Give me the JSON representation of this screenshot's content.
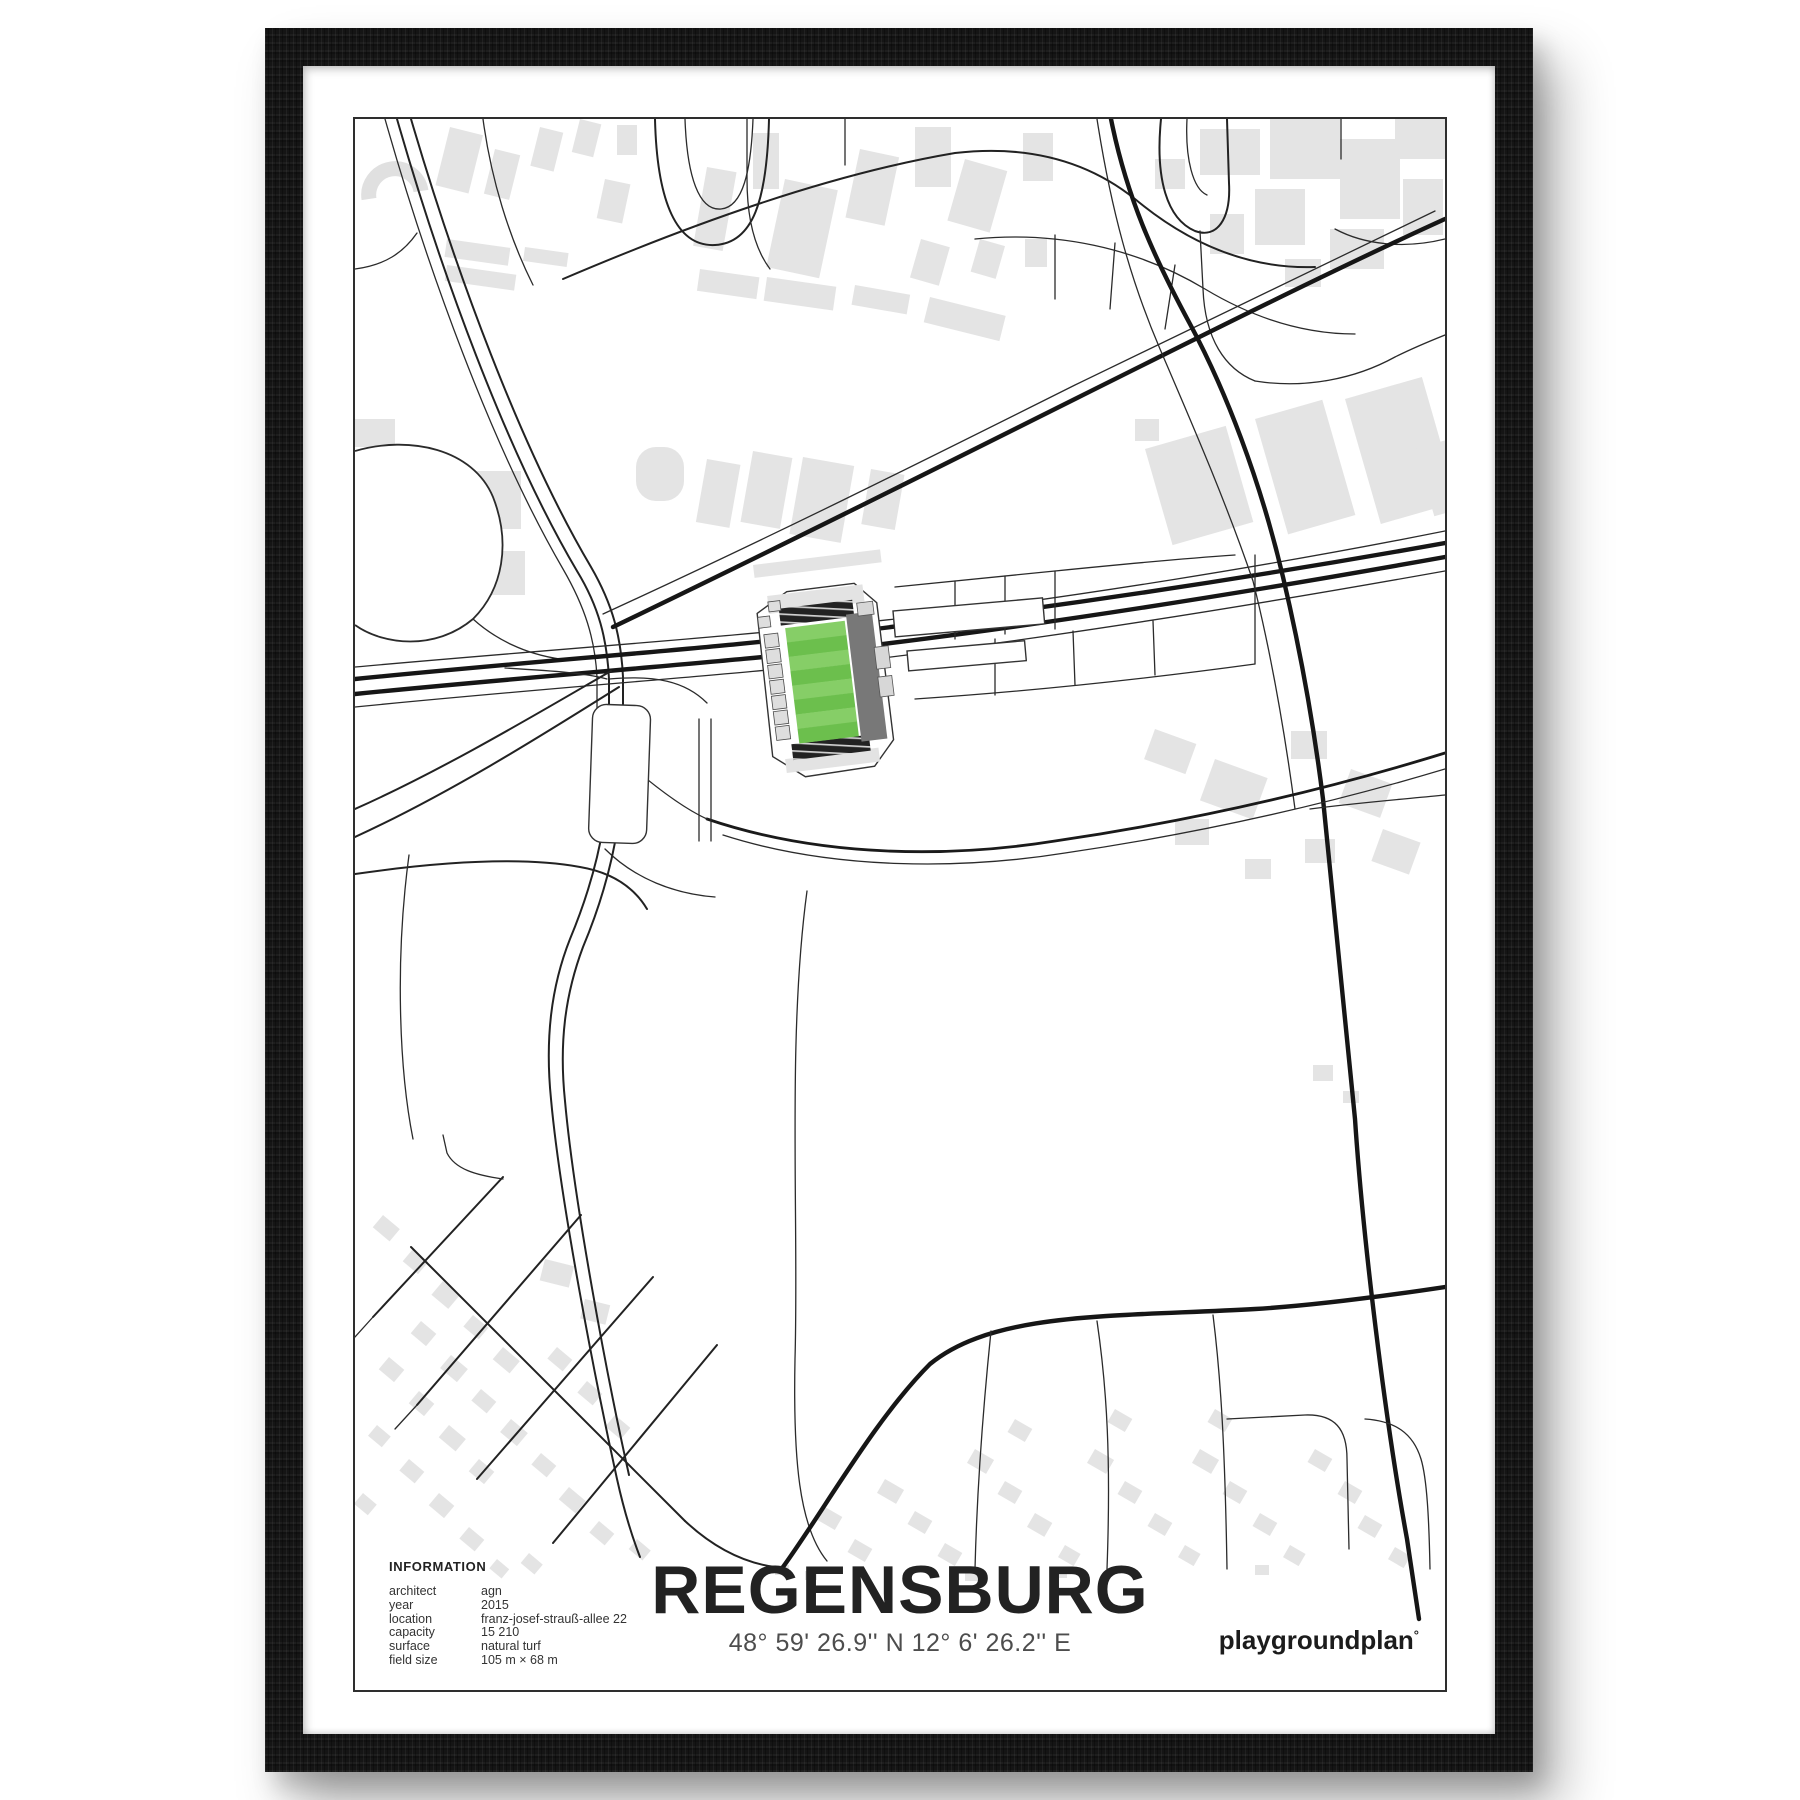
{
  "poster": {
    "title": "REGENSBURG",
    "coordinates": "48° 59' 26.9'' N  12° 6' 26.2'' E",
    "brand": "playgroundplan",
    "brand_mark": "°",
    "information": {
      "heading": "INFORMATION",
      "rows": [
        {
          "label": "architect",
          "value": "agn"
        },
        {
          "label": "year",
          "value": "2015"
        },
        {
          "label": "location",
          "value": "franz-josef-strauß-allee 22"
        },
        {
          "label": "capacity",
          "value": "15 210"
        },
        {
          "label": "surface",
          "value": "natural turf"
        },
        {
          "label": "field size",
          "value": "105 m × 68 m"
        }
      ]
    }
  },
  "map": {
    "stadium": {
      "pitch_stripes": 8
    },
    "colors": {
      "pitch_green": "#6cbf4d",
      "pitch_green_light": "#86ce67",
      "building_gray": "#e4e4e4",
      "road_dark": "#161616",
      "frame_black": "#151515",
      "paper_white": "#ffffff"
    }
  }
}
